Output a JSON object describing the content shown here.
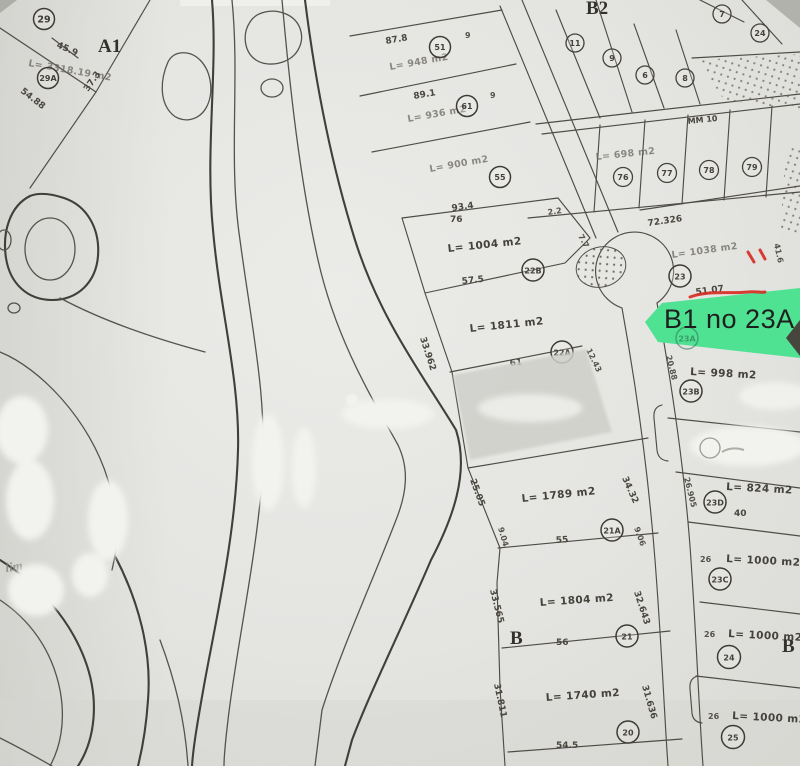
{
  "map": {
    "highlight": {
      "label": "B1 no 23A",
      "parcel_num": "23A",
      "color": "#4fe293",
      "annotation_color": "#d62b20"
    },
    "zone_labels": {
      "a1": "A1",
      "b2": "B2",
      "b_left": "B",
      "b_right": "B"
    },
    "road_label": "MM 10",
    "handwriting": "lim",
    "parcels": {
      "p29": {
        "num": "29"
      },
      "p29a": {
        "num": "29A",
        "area": "L= 3318.19 m2",
        "front": "45.9",
        "side_left": "54.88",
        "side_right": "37.3"
      },
      "p51": {
        "num": "51",
        "front": "87.8",
        "area": "L= 948 m2",
        "tick": "9"
      },
      "p61": {
        "num": "61",
        "front": "89.1",
        "area": "L= 936 m2",
        "tick": "9"
      },
      "p55": {
        "num": "55",
        "front": "93.4",
        "area": "L= 900 m2"
      },
      "p22b": {
        "num": "22B",
        "area": "L= 1004 m2",
        "front": "57.5",
        "top": "76",
        "side_right": "7.7",
        "tick": "2.2"
      },
      "p22a": {
        "num": "22A",
        "area": "L= 1811 m2",
        "front": "61",
        "side_left": "33.962",
        "side_right": "12.43"
      },
      "p21a": {
        "num": "21A",
        "area": "L= 1789 m2",
        "front": "55",
        "side_left": "25.05",
        "side_left2": "9.04",
        "side_right": "34.32",
        "side_right2": "9.06"
      },
      "p21": {
        "num": "21",
        "area": "L= 1804 m2",
        "front": "56",
        "side_left": "33.565",
        "side_right": "32.643"
      },
      "p20": {
        "num": "20",
        "area": "L= 1740 m2",
        "front": "54.5",
        "side_left": "31.811",
        "side_right": "31.636"
      },
      "p23": {
        "num": "23",
        "area": "L= 1038 m2",
        "front": "51.07",
        "top": "72.326",
        "side_right": "41.6"
      },
      "p23b": {
        "num": "23B",
        "area": "L= 998 m2",
        "side_left": "20.88"
      },
      "p23d": {
        "num": "23D",
        "area": "L= 824 m2",
        "front": "40",
        "side_left": "26.905"
      },
      "p23c": {
        "num": "23C",
        "area": "L= 1000 m2",
        "front_left": "26"
      },
      "p24": {
        "num": "24",
        "area": "L= 1000 m2",
        "front_left": "26"
      },
      "p25": {
        "num": "25",
        "area": "L= 1000 m2",
        "front_left": "26"
      },
      "small": {
        "n7": "7",
        "n24": "24",
        "n11": "11",
        "n9": "9",
        "n6": "6",
        "n8": "8",
        "n76": "76",
        "n77": "77",
        "n78": "78",
        "n79": "79",
        "area": "L= 698 m2"
      }
    }
  }
}
